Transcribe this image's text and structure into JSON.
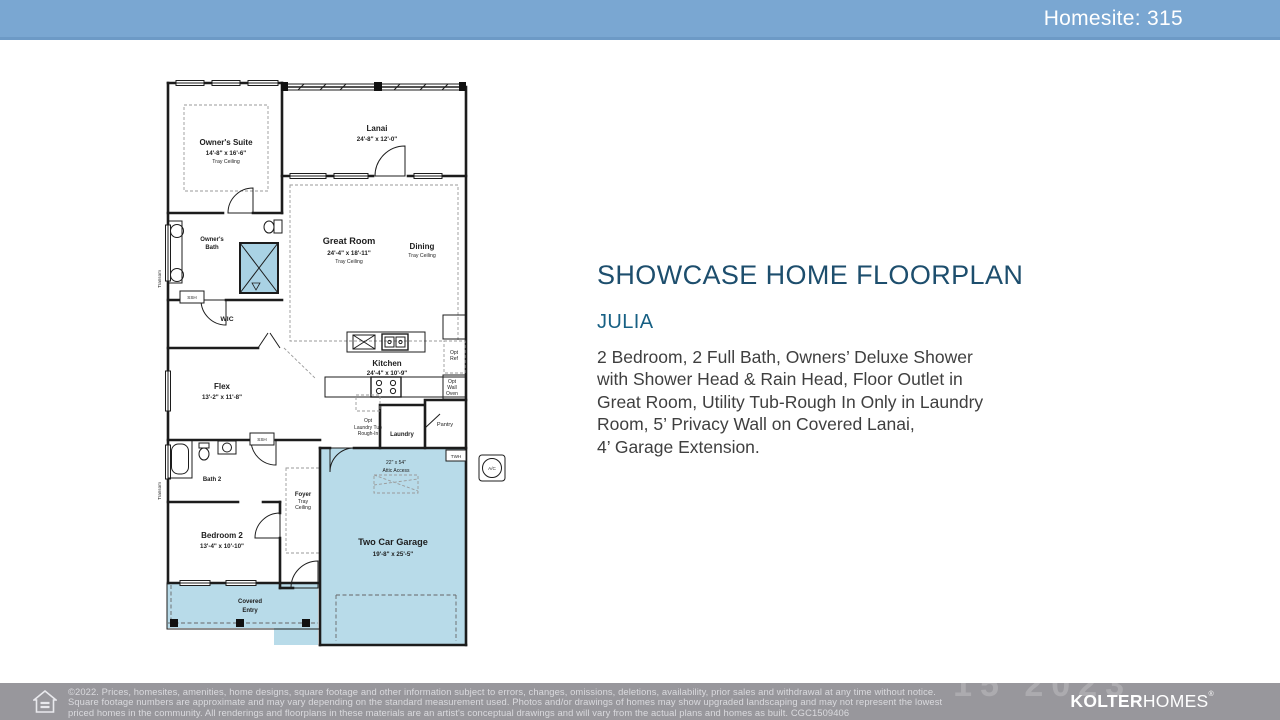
{
  "header": {
    "homesite_label": "Homesite: 315"
  },
  "main": {
    "title": "SHOWCASE HOME FLOORPLAN",
    "model_name": "JULIA",
    "description_lines": [
      "2 Bedroom, 2 Full Bath, Owners’ Deluxe Shower",
      "with Shower Head & Rain Head, Floor Outlet in",
      "Great Room, Utility Tub-Rough In Only in Laundry",
      "Room, 5’ Privacy Wall on Covered Lanai,",
      "4’ Garage Extension."
    ]
  },
  "floorplan": {
    "labels": {
      "owners_suite": "Owner's Suite",
      "owners_suite_dim": "14'-8\" x 16'-6\"",
      "tray_ceiling": "Tray Ceiling",
      "lanai": "Lanai",
      "lanai_dim": "24'-8\" x 12'-0\"",
      "owners_bath_1": "Owner's",
      "owners_bath_2": "Bath",
      "wic": "WIC",
      "great_room": "Great Room",
      "great_room_dim": "24'-4\" x 18'-11\"",
      "dining": "Dining",
      "kitchen": "Kitchen",
      "kitchen_dim": "24'-4\" x 10'-9\"",
      "flex": "Flex",
      "flex_dim": "13'-2\" x 11'-8\"",
      "opt": "Opt",
      "ref": "Ref",
      "wall": "Wall",
      "oven": "Oven",
      "pantry": "Pantry",
      "laundry": "Laundry",
      "opt_laundry_2": "Laundry Tub",
      "opt_laundry_3": "Rough-In",
      "bath_2": "Bath 2",
      "bedroom_2": "Bedroom 2",
      "bedroom_2_dim": "13'-4\" x 10'-10\"",
      "foyer": "Foyer",
      "foyer_tray_1": "Tray",
      "foyer_tray_2": "Ceiling",
      "garage": "Two Car Garage",
      "garage_dim": "19'-8\" x 25'-5\"",
      "attic_1": "22\" x 54\"",
      "attic_2": "Attic Access",
      "covered_1": "Covered",
      "covered_2": "Entry",
      "twh": "TWH",
      "ac": "A/C",
      "ssh": "SSH",
      "transom": "Transom"
    }
  },
  "footer": {
    "line1": "©2022. Prices, homesites, amenities, home designs, square footage and other information subject to errors, changes, omissions, deletions, availability, prior sales and withdrawal at any time without notice.",
    "line2": "Square footage numbers are approximate and may vary depending on the standard measurement used. Photos and/or drawings of homes may show upgraded landscaping and may not represent the lowest",
    "line3": "priced homes in the community. All renderings and floorplans in these materials are an artist's conceptual drawings and will vary from the actual plans and homes as built. CGC1509406",
    "brand_bold": "KOLTER",
    "brand_light": "HOMES",
    "brand_reg": "®",
    "watermark": "15 2023"
  },
  "colors": {
    "top_bar": "#7aa7d2",
    "floorplan_fill": "#b8dbe9",
    "title_text": "#1d4e6d",
    "model_text": "#176084",
    "body_text": "#3f3f3f",
    "footer_bg": "#98979c",
    "footer_text": "#dadade"
  }
}
